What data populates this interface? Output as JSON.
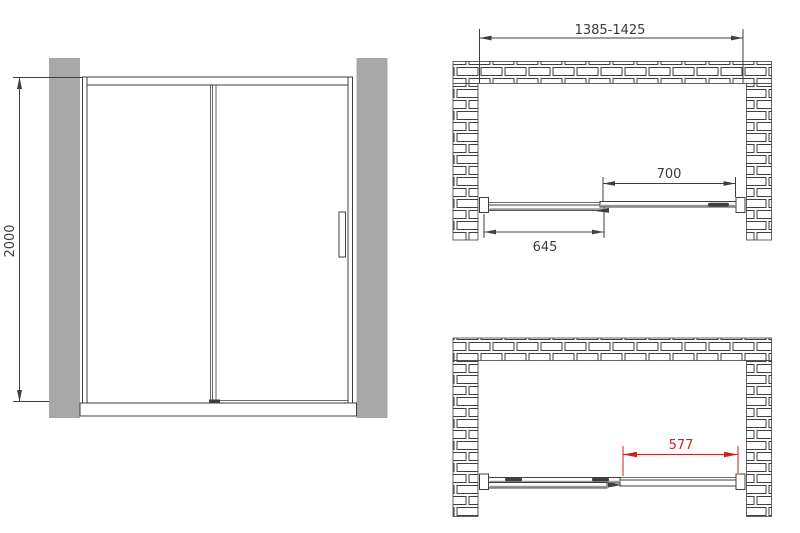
{
  "drawing": {
    "title": "sliding-shower-door-technical-drawing",
    "colors": {
      "bg": "#ffffff",
      "line": "#3f3f3f",
      "wall_fill": "#a8a8a8",
      "dim_red": "#cc2222",
      "text": "#3a3a3a"
    },
    "views": {
      "front_elevation": {
        "height_dim": "2000"
      },
      "plan_closed": {
        "overall_width_dim": "1385-1425",
        "sliding_panel_dim": "700",
        "fixed_panel_dim": "645"
      },
      "plan_open": {
        "opening_dim": "577"
      }
    }
  }
}
